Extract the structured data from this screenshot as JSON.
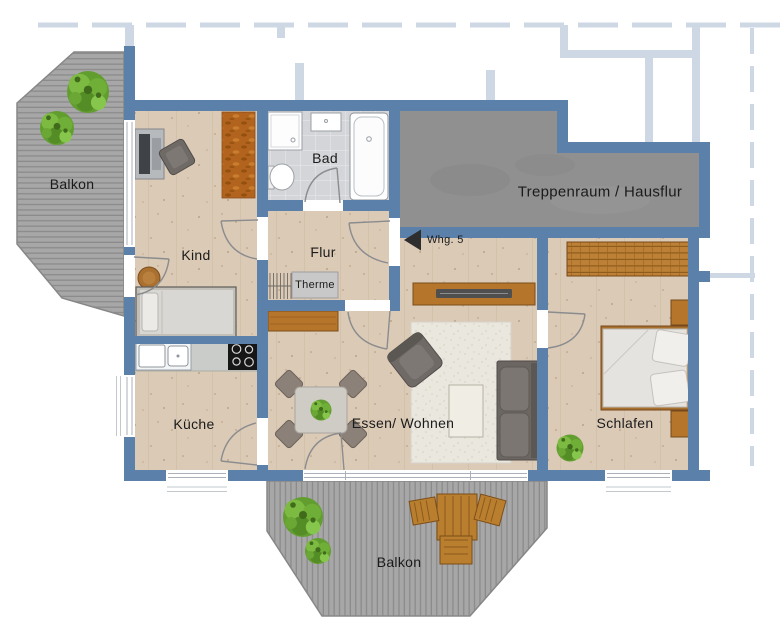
{
  "plan": {
    "rooms": {
      "balkon_top": "Balkon",
      "kind": "Kind",
      "bad": "Bad",
      "flur": "Flur",
      "treppenraum": "Treppenraum / Hausflur",
      "kueche": "Küche",
      "essen_wohnen": "Essen/ Wohnen",
      "schlafen": "Schlafen",
      "balkon_unten": "Balkon"
    },
    "annotations": {
      "entry": "Whg. 5",
      "therme": "Therme"
    },
    "colors": {
      "wall": "#5b81ab",
      "ghost_wall": "#cdd8e4",
      "wood_floor": "#dbcab6",
      "bath_tile": "#d4d5d8",
      "stair_floor": "#909090",
      "deck": "#a7a7a7",
      "furniture_wood": "#b5762c",
      "rug_orange": "#b2641f",
      "rug_cream": "#eae7df",
      "sofa_gray": "#6b6662",
      "plant_green": "#629e2f",
      "label_text": "#1b1b1b"
    }
  }
}
